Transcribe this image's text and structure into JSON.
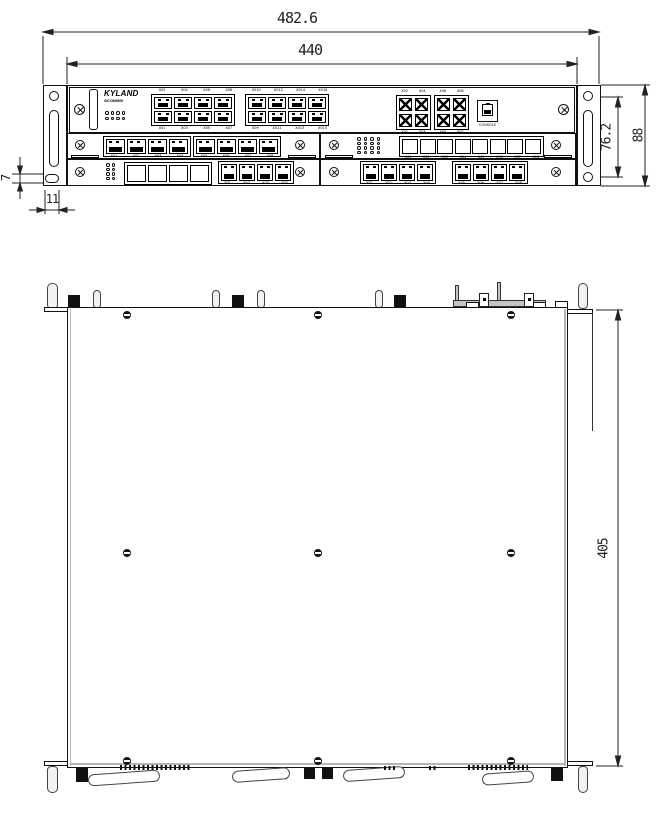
{
  "dimensions": {
    "overall_width": "482.6",
    "mounting_width": "440",
    "hole_spacing": "76.2",
    "overall_height": "88",
    "ear_offset": "7",
    "ear_tab_width": "11",
    "depth": "405"
  },
  "front_view": {
    "brand": "KYLAND",
    "model": "SICOM6800",
    "console_label": "CONSOLE",
    "labels": {
      "rj45_block1_top": [
        "X02",
        "X04",
        "X06",
        "X08"
      ],
      "rj45_block1_bottom": [
        "X01",
        "X03",
        "X05",
        "X07"
      ],
      "rj45_block2_top": [
        "X010",
        "X012",
        "X014",
        "X016"
      ],
      "rj45_block2_bottom": [
        "X09",
        "X011",
        "X013",
        "X015"
      ],
      "sfp_block1_top": [
        "X02",
        "X04"
      ],
      "sfp_block1_bottom": [
        "X01",
        "X03"
      ],
      "sfp_block2_top": [
        "X06",
        "X08"
      ],
      "sfp_block2_bottom": [
        "X05",
        "X07"
      ],
      "module_ports_a": [
        "X01",
        "X02",
        "X03",
        "X04"
      ],
      "module_ports_b": [
        "X05",
        "X06",
        "X07",
        "X08"
      ],
      "slot_ports": [
        "X01",
        "X02",
        "X03",
        "X04",
        "X05",
        "X06",
        "X07",
        "X08"
      ]
    }
  }
}
